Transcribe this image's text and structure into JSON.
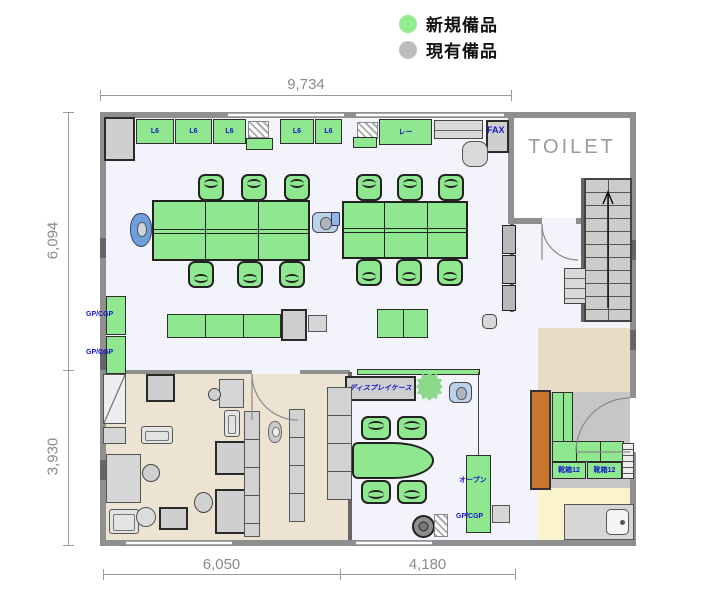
{
  "legend": {
    "items": [
      {
        "label": "新規備品",
        "color": "#90ee90"
      },
      {
        "label": "現有備品",
        "color": "#bdbdbd"
      }
    ]
  },
  "dimensions": {
    "top": "9,734",
    "left_upper": "6,094",
    "left_lower": "3,930",
    "bottom_left": "6,050",
    "bottom_right": "4,180"
  },
  "rooms": {
    "toilet_label": "TOILET"
  },
  "colors": {
    "new_equipment_green": "#8fe78f",
    "existing_equipment_gray": "#d6d6d6",
    "wall_gray": "#8f8f8f",
    "floor_main": "#f3f4fb",
    "floor_office": "#ece3d2",
    "floor_entry_yellow": "#fbf3cd",
    "orange_cabinet": "#c9772e",
    "label_blue": "#1414cc"
  },
  "floorplan": {
    "items": [
      {
        "name": "floor-main",
        "cls": "floor-main",
        "x": 106,
        "y": 118,
        "w": 524,
        "h": 422
      },
      {
        "name": "floor-toilet",
        "cls": "floor-white",
        "x": 514,
        "y": 118,
        "w": 116,
        "h": 100
      },
      {
        "name": "floor-office",
        "cls": "floor-beige",
        "x": 106,
        "y": 374,
        "w": 242,
        "h": 166
      },
      {
        "name": "floor-right-tan",
        "cls": "floor-tan",
        "x": 538,
        "y": 328,
        "w": 92,
        "h": 64
      },
      {
        "name": "floor-right-gray",
        "cls": "floor-gray",
        "x": 548,
        "y": 392,
        "w": 82,
        "h": 96
      },
      {
        "name": "floor-entry-yellow",
        "cls": "floor-yellow",
        "x": 538,
        "y": 488,
        "w": 92,
        "h": 52
      },
      {
        "name": "wall-top",
        "cls": "wall",
        "x": 100,
        "y": 112,
        "w": 536,
        "h": 6
      },
      {
        "name": "wall-left",
        "cls": "wall",
        "x": 100,
        "y": 112,
        "w": 6,
        "h": 434
      },
      {
        "name": "wall-bottom",
        "cls": "wall",
        "x": 100,
        "y": 540,
        "w": 536,
        "h": 6
      },
      {
        "name": "wall-right-upper",
        "cls": "wall",
        "x": 630,
        "y": 112,
        "w": 6,
        "h": 286
      },
      {
        "name": "wall-right-lower",
        "cls": "wall",
        "x": 630,
        "y": 452,
        "w": 6,
        "h": 94
      },
      {
        "name": "wall-toilet-left",
        "cls": "wall",
        "x": 508,
        "y": 112,
        "w": 6,
        "h": 112
      },
      {
        "name": "wall-toilet-bottom",
        "cls": "wall",
        "x": 508,
        "y": 218,
        "w": 34,
        "h": 6
      },
      {
        "name": "wall-toilet-stub",
        "cls": "wall",
        "x": 576,
        "y": 218,
        "w": 10,
        "h": 6
      },
      {
        "name": "wall-partition-right",
        "cls": "wall-dark",
        "x": 510,
        "y": 224,
        "w": 4,
        "h": 88
      },
      {
        "name": "wall-office-top-a",
        "cls": "wall-thin",
        "x": 106,
        "y": 370,
        "w": 146,
        "h": 4
      },
      {
        "name": "wall-office-top-b",
        "cls": "wall-thin",
        "x": 300,
        "y": 370,
        "w": 50,
        "h": 4
      },
      {
        "name": "wall-office-right",
        "cls": "wall-dark",
        "x": 348,
        "y": 372,
        "w": 4,
        "h": 168
      },
      {
        "name": "wall-stairs-left",
        "cls": "wall-dark",
        "x": 581,
        "y": 178,
        "w": 4,
        "h": 144
      },
      {
        "name": "pilaster",
        "cls": "wall-dark",
        "x": 100,
        "y": 238,
        "w": 6,
        "h": 20
      },
      {
        "name": "pilaster",
        "cls": "wall-dark",
        "x": 100,
        "y": 350,
        "w": 6,
        "h": 20
      },
      {
        "name": "pilaster",
        "cls": "wall-dark",
        "x": 100,
        "y": 460,
        "w": 6,
        "h": 20
      },
      {
        "name": "pilaster",
        "cls": "wall-dark",
        "x": 630,
        "y": 240,
        "w": 6,
        "h": 20
      },
      {
        "name": "pilaster",
        "cls": "wall-dark",
        "x": 630,
        "y": 330,
        "w": 6,
        "h": 20
      },
      {
        "name": "window-top-1",
        "cls": "window",
        "x": 228,
        "y": 113,
        "w": 116,
        "h": 4
      },
      {
        "name": "window-top-2",
        "cls": "window",
        "x": 356,
        "y": 113,
        "w": 148,
        "h": 4
      },
      {
        "name": "window-bottom-1",
        "cls": "window",
        "x": 126,
        "y": 541,
        "w": 106,
        "h": 4
      },
      {
        "name": "window-bottom-2",
        "cls": "window",
        "x": 356,
        "y": 541,
        "w": 76,
        "h": 4
      },
      {
        "name": "stairs",
        "cls": "stairs",
        "x": 584,
        "y": 178,
        "w": 48,
        "h": 144
      },
      {
        "name": "cabinet-gray",
        "cls": "g-dark",
        "x": 104,
        "y": 117,
        "w": 31,
        "h": 44
      },
      {
        "name": "cabinet",
        "cls": "g-green",
        "x": 136,
        "y": 119,
        "w": 38,
        "h": 25,
        "label": "L6"
      },
      {
        "name": "cabinet",
        "cls": "g-green",
        "x": 175,
        "y": 119,
        "w": 37,
        "h": 25,
        "label": "L6"
      },
      {
        "name": "cabinet",
        "cls": "g-green",
        "x": 213,
        "y": 119,
        "w": 33,
        "h": 25,
        "label": "L6"
      },
      {
        "name": "hatch-mat",
        "cls": "hatch",
        "x": 248,
        "y": 121,
        "w": 21,
        "h": 17
      },
      {
        "name": "cabinet-low",
        "cls": "g-green",
        "x": 246,
        "y": 138,
        "w": 27,
        "h": 12
      },
      {
        "name": "cabinet",
        "cls": "g-green",
        "x": 280,
        "y": 119,
        "w": 34,
        "h": 25,
        "label": "L6"
      },
      {
        "name": "cabinet",
        "cls": "g-green",
        "x": 315,
        "y": 119,
        "w": 27,
        "h": 25,
        "label": "L6"
      },
      {
        "name": "hatch-mat",
        "cls": "hatch",
        "x": 357,
        "y": 122,
        "w": 21,
        "h": 17
      },
      {
        "name": "cabinet-low",
        "cls": "g-green",
        "x": 353,
        "y": 137,
        "w": 24,
        "h": 11
      },
      {
        "name": "cabinet-wide",
        "cls": "g-green",
        "x": 379,
        "y": 119,
        "w": 53,
        "h": 26,
        "label": "レー"
      },
      {
        "name": "copier-counter",
        "cls": "g-shelf",
        "x": 434,
        "y": 120,
        "w": 49,
        "h": 19
      },
      {
        "name": "fax-unit",
        "cls": "g-dark",
        "x": 486,
        "y": 120,
        "w": 23,
        "h": 33
      },
      {
        "name": "round-table",
        "cls": "octagon",
        "x": 462,
        "y": 141,
        "w": 26,
        "h": 26
      },
      {
        "name": "desk-island",
        "cls": "desks",
        "x": 152,
        "y": 200,
        "w": 158,
        "h": 61
      },
      {
        "name": "chair",
        "cls": "chair-g chair-up",
        "x": 198,
        "y": 174,
        "w": 26,
        "h": 27
      },
      {
        "name": "chair",
        "cls": "chair-g chair-up",
        "x": 241,
        "y": 174,
        "w": 26,
        "h": 27
      },
      {
        "name": "chair",
        "cls": "chair-g chair-up",
        "x": 284,
        "y": 174,
        "w": 26,
        "h": 27
      },
      {
        "name": "chair",
        "cls": "chair-g chair-down",
        "x": 188,
        "y": 261,
        "w": 26,
        "h": 27
      },
      {
        "name": "chair",
        "cls": "chair-g chair-down",
        "x": 237,
        "y": 261,
        "w": 26,
        "h": 27
      },
      {
        "name": "chair",
        "cls": "chair-g chair-down",
        "x": 279,
        "y": 261,
        "w": 26,
        "h": 27
      },
      {
        "name": "person",
        "cls": "person",
        "x": 130,
        "y": 213,
        "w": 22,
        "h": 34
      },
      {
        "name": "chair-occupied",
        "cls": "chair-blue",
        "x": 312,
        "y": 212,
        "w": 26,
        "h": 21
      },
      {
        "name": "desk-island",
        "cls": "desks",
        "x": 342,
        "y": 201,
        "w": 126,
        "h": 58
      },
      {
        "name": "chair",
        "cls": "chair-g chair-up",
        "x": 356,
        "y": 174,
        "w": 26,
        "h": 27
      },
      {
        "name": "chair",
        "cls": "chair-g chair-up",
        "x": 397,
        "y": 174,
        "w": 26,
        "h": 27
      },
      {
        "name": "chair",
        "cls": "chair-g chair-up",
        "x": 438,
        "y": 174,
        "w": 26,
        "h": 27
      },
      {
        "name": "chair",
        "cls": "chair-g chair-down",
        "x": 356,
        "y": 259,
        "w": 26,
        "h": 27
      },
      {
        "name": "chair",
        "cls": "chair-g chair-down",
        "x": 396,
        "y": 259,
        "w": 26,
        "h": 27
      },
      {
        "name": "chair",
        "cls": "chair-g chair-down",
        "x": 437,
        "y": 259,
        "w": 26,
        "h": 27
      },
      {
        "name": "bag",
        "cls": "mini-blue",
        "x": 331,
        "y": 212,
        "w": 9,
        "h": 14
      },
      {
        "name": "counter",
        "cls": "g-green seg3",
        "x": 167,
        "y": 314,
        "w": 114,
        "h": 24
      },
      {
        "name": "cart",
        "cls": "g-dark",
        "x": 281,
        "y": 309,
        "w": 26,
        "h": 32
      },
      {
        "name": "cart-tray",
        "cls": "g-gray",
        "x": 308,
        "y": 315,
        "w": 19,
        "h": 17
      },
      {
        "name": "work-table",
        "cls": "g-green seg2",
        "x": 377,
        "y": 309,
        "w": 51,
        "h": 29
      },
      {
        "name": "stool",
        "cls": "chair-gray",
        "x": 482,
        "y": 314,
        "w": 15,
        "h": 15
      },
      {
        "name": "cabinet-wall",
        "cls": "g-green",
        "x": 106,
        "y": 296,
        "w": 20,
        "h": 39
      },
      {
        "name": "cabinet-wall",
        "cls": "g-green",
        "x": 106,
        "y": 336,
        "w": 20,
        "h": 38
      },
      {
        "name": "shelf-strip",
        "cls": "g-green",
        "x": 357,
        "y": 369,
        "w": 123,
        "h": 6
      },
      {
        "name": "display-case",
        "cls": "g-dark",
        "x": 345,
        "y": 376,
        "w": 71,
        "h": 25,
        "label": "ディスプレイケース",
        "labelCls": "lbl-italic"
      },
      {
        "name": "plant",
        "cls": "plant-star",
        "x": 416,
        "y": 372,
        "w": 27,
        "h": 29
      },
      {
        "name": "chair-occupied",
        "cls": "chair-blue",
        "x": 449,
        "y": 382,
        "w": 23,
        "h": 21
      },
      {
        "name": "meeting-table",
        "cls": "table-oval",
        "x": 352,
        "y": 442,
        "w": 82,
        "h": 37
      },
      {
        "name": "chair",
        "cls": "chair-g chair-up",
        "x": 361,
        "y": 416,
        "w": 30,
        "h": 24
      },
      {
        "name": "chair",
        "cls": "chair-g chair-up",
        "x": 397,
        "y": 416,
        "w": 30,
        "h": 24
      },
      {
        "name": "chair",
        "cls": "chair-g chair-down",
        "x": 361,
        "y": 480,
        "w": 30,
        "h": 24
      },
      {
        "name": "chair",
        "cls": "chair-g chair-down",
        "x": 397,
        "y": 480,
        "w": 30,
        "h": 24
      },
      {
        "name": "plant-pot",
        "cls": "plant-round",
        "x": 412,
        "y": 515,
        "w": 23,
        "h": 23
      },
      {
        "name": "mat",
        "cls": "hatch",
        "x": 434,
        "y": 514,
        "w": 14,
        "h": 23
      },
      {
        "name": "partition-line",
        "cls": "line-v",
        "x": 478,
        "y": 372,
        "w": 1,
        "h": 84
      },
      {
        "name": "open-shelf",
        "cls": "g-green",
        "x": 466,
        "y": 455,
        "w": 25,
        "h": 78
      },
      {
        "name": "box",
        "cls": "g-gray",
        "x": 492,
        "y": 505,
        "w": 18,
        "h": 18
      },
      {
        "name": "wall-cabinet",
        "cls": "g-dark2",
        "x": 502,
        "y": 225,
        "w": 14,
        "h": 29
      },
      {
        "name": "wall-cabinet",
        "cls": "g-dark2",
        "x": 502,
        "y": 255,
        "w": 14,
        "h": 29
      },
      {
        "name": "wall-cabinet",
        "cls": "g-dark2",
        "x": 502,
        "y": 285,
        "w": 14,
        "h": 26
      },
      {
        "name": "appliance",
        "cls": "g-shelf",
        "x": 564,
        "y": 268,
        "w": 22,
        "h": 36
      },
      {
        "name": "tall-cabinet-orange",
        "cls": "orange",
        "x": 530,
        "y": 390,
        "w": 21,
        "h": 100
      },
      {
        "name": "counter-col",
        "cls": "g-green seg2",
        "x": 552,
        "y": 392,
        "w": 21,
        "h": 50
      },
      {
        "name": "counter-row",
        "cls": "g-green seg3",
        "x": 552,
        "y": 441,
        "w": 72,
        "h": 21
      },
      {
        "name": "cabinet-labeled",
        "cls": "g-green",
        "x": 552,
        "y": 462,
        "w": 34,
        "h": 17,
        "label": "靴箱12"
      },
      {
        "name": "cabinet-labeled",
        "cls": "g-green",
        "x": 587,
        "y": 462,
        "w": 35,
        "h": 17,
        "label": "靴箱12"
      },
      {
        "name": "entrance-steps",
        "cls": "steps",
        "x": 622,
        "y": 443,
        "w": 12,
        "h": 36
      },
      {
        "name": "sink-counter",
        "cls": "g-gray",
        "x": 564,
        "y": 504,
        "w": 70,
        "h": 36
      },
      {
        "name": "sink",
        "cls": "sink",
        "x": 606,
        "y": 509,
        "w": 23,
        "h": 26
      },
      {
        "name": "locker-diag",
        "cls": "diag",
        "x": 103,
        "y": 374,
        "w": 23,
        "h": 50
      },
      {
        "name": "cabinet-low",
        "cls": "g-gray",
        "x": 103,
        "y": 427,
        "w": 23,
        "h": 17
      },
      {
        "name": "printer",
        "cls": "g-dark",
        "x": 146,
        "y": 374,
        "w": 29,
        "h": 28
      },
      {
        "name": "sofa",
        "cls": "sofa",
        "x": 141,
        "y": 426,
        "w": 32,
        "h": 18
      },
      {
        "name": "desk",
        "cls": "g-gray",
        "x": 219,
        "y": 379,
        "w": 25,
        "h": 29
      },
      {
        "name": "chair",
        "cls": "chair-gray-round",
        "x": 208,
        "y": 388,
        "w": 13,
        "h": 13
      },
      {
        "name": "sofa",
        "cls": "sofa",
        "x": 224,
        "y": 410,
        "w": 16,
        "h": 27
      },
      {
        "name": "desk-large",
        "cls": "g-gray",
        "x": 106,
        "y": 454,
        "w": 35,
        "h": 49
      },
      {
        "name": "chair",
        "cls": "chair-gray-round",
        "x": 142,
        "y": 464,
        "w": 18,
        "h": 18
      },
      {
        "name": "sofa",
        "cls": "sofa",
        "x": 109,
        "y": 509,
        "w": 30,
        "h": 25
      },
      {
        "name": "round-table",
        "cls": "circle-gray",
        "x": 136,
        "y": 507,
        "w": 20,
        "h": 20
      },
      {
        "name": "printer",
        "cls": "g-dark",
        "x": 159,
        "y": 507,
        "w": 29,
        "h": 23
      },
      {
        "name": "copier-desk",
        "cls": "g-dark",
        "x": 215,
        "y": 441,
        "w": 33,
        "h": 34
      },
      {
        "name": "copier-desk",
        "cls": "g-dark",
        "x": 215,
        "y": 489,
        "w": 33,
        "h": 45
      },
      {
        "name": "chair",
        "cls": "chair-gray-round",
        "x": 194,
        "y": 492,
        "w": 19,
        "h": 21
      },
      {
        "name": "cabinet-col",
        "cls": "shelf-v",
        "x": 244,
        "y": 411,
        "w": 16,
        "h": 126
      },
      {
        "name": "shelf",
        "cls": "shelf-v",
        "x": 289,
        "y": 409,
        "w": 16,
        "h": 113
      },
      {
        "name": "shelf",
        "cls": "shelf-v",
        "x": 327,
        "y": 387,
        "w": 25,
        "h": 113
      },
      {
        "name": "person",
        "cls": "person-gray",
        "x": 268,
        "y": 421,
        "w": 14,
        "h": 22
      }
    ],
    "texts": [
      {
        "text": "FAX",
        "x": 487,
        "y": 125,
        "cls": "lbl-fax"
      },
      {
        "text": "GP/CGP",
        "x": 86,
        "y": 311,
        "cls": ""
      },
      {
        "text": "GP/CGP",
        "x": 86,
        "y": 349,
        "cls": ""
      },
      {
        "text": "オープン",
        "x": 459,
        "y": 475,
        "cls": ""
      },
      {
        "text": "GP/CGP",
        "x": 456,
        "y": 513,
        "cls": ""
      }
    ]
  }
}
